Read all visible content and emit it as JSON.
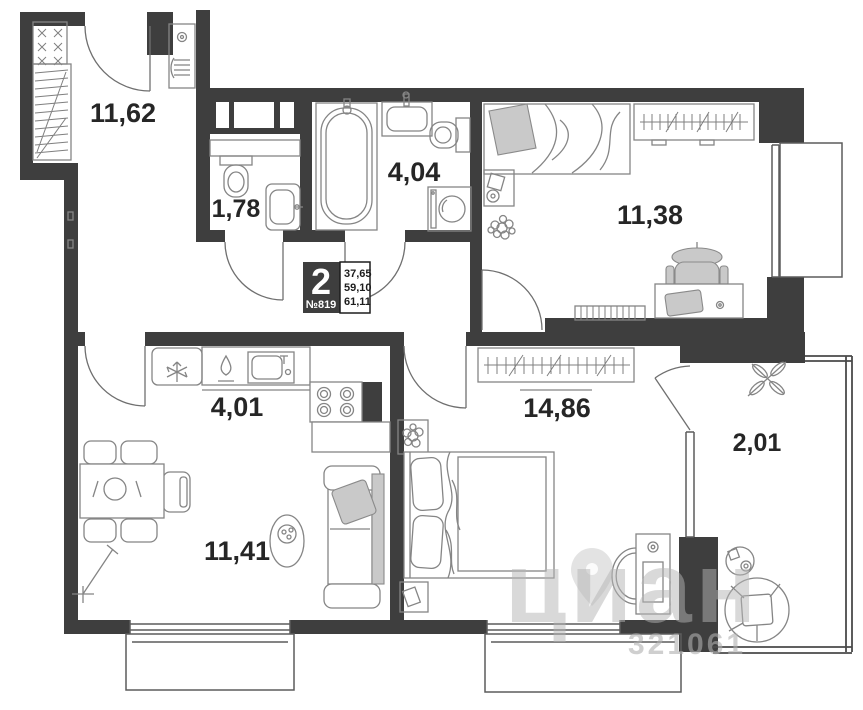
{
  "unit": {
    "rooms_count": "2",
    "number": "№819",
    "areas": [
      "37,65",
      "59,10",
      "61,11"
    ]
  },
  "rooms": {
    "hallway": {
      "area": "11,62"
    },
    "wc": {
      "area": "1,78"
    },
    "bathroom": {
      "area": "4,04"
    },
    "bedroom_top": {
      "area": "11,38"
    },
    "kitchen": {
      "area": "4,01"
    },
    "bedroom_main": {
      "area": "14,86"
    },
    "living": {
      "area": "11,41"
    },
    "balcony": {
      "area": "2,01"
    }
  },
  "watermark": {
    "brand": "циан",
    "number": "321061"
  },
  "colors": {
    "wall": "#3e3e3e",
    "furniture_line": "#858585",
    "label": "#262626",
    "watermark": "#b5b5b5"
  }
}
